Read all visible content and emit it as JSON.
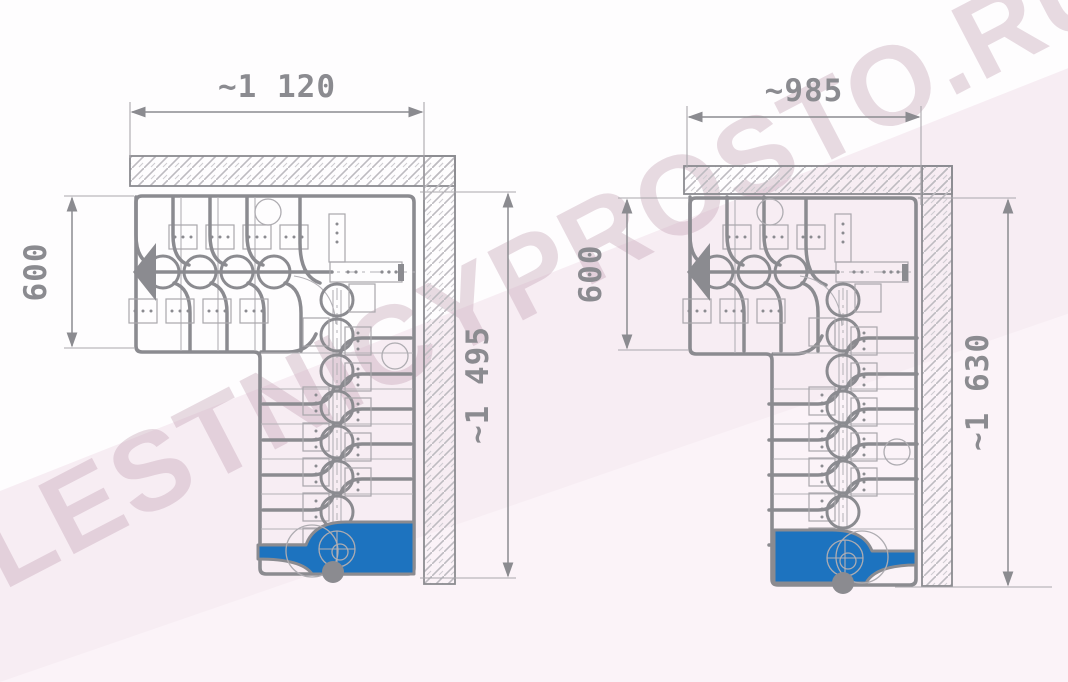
{
  "watermark": {
    "text": "LESTNICYPROSTO.RU"
  },
  "colors": {
    "line_gray": "#8b8b90",
    "thin_gray": "#b3b1b6",
    "hatch_gray": "#bdbbc0",
    "accent_blue": "#1d73bf",
    "dim_text_gray": "#8b8b90",
    "watermark_pink": "#c5a4b6",
    "band_pink": "#f7edf3",
    "band_pink_light": "#fbf3f8",
    "background": "#fefdfe"
  },
  "left_drawing": {
    "name": "staircase-plan-variant-1",
    "dim_top": "~1 120",
    "dim_side": "600",
    "dim_height": "~1 495"
  },
  "right_drawing": {
    "name": "staircase-plan-variant-2",
    "dim_top": "~985",
    "dim_side": "600",
    "dim_height": "~1 630"
  }
}
